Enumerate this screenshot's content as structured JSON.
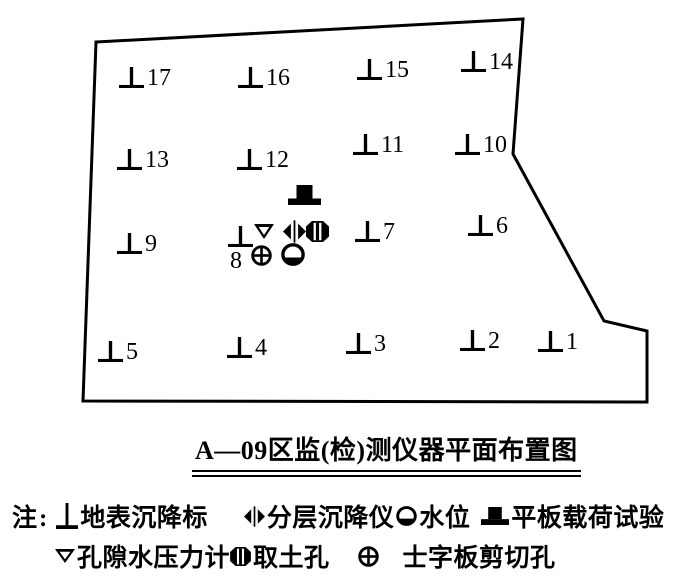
{
  "figure": {
    "background": "#ffffff",
    "ink": "#000000"
  },
  "plan": {
    "boundary_points": "96,42 523,19 513,154 604,321 647,331 647,402 83,401",
    "markers": [
      {
        "n": "17",
        "x": 119,
        "y": 64,
        "label_pos": "right"
      },
      {
        "n": "16",
        "x": 238,
        "y": 64,
        "label_pos": "right"
      },
      {
        "n": "15",
        "x": 357,
        "y": 56,
        "label_pos": "right"
      },
      {
        "n": "14",
        "x": 461,
        "y": 48,
        "label_pos": "right"
      },
      {
        "n": "13",
        "x": 117,
        "y": 146,
        "label_pos": "right"
      },
      {
        "n": "12",
        "x": 237,
        "y": 146,
        "label_pos": "right"
      },
      {
        "n": "11",
        "x": 353,
        "y": 131,
        "label_pos": "right"
      },
      {
        "n": "10",
        "x": 455,
        "y": 131,
        "label_pos": "right"
      },
      {
        "n": "9",
        "x": 117,
        "y": 230,
        "label_pos": "right"
      },
      {
        "n": "8",
        "x": 228,
        "y": 226,
        "label_pos": "below"
      },
      {
        "n": "7",
        "x": 355,
        "y": 218,
        "label_pos": "right"
      },
      {
        "n": "6",
        "x": 468,
        "y": 212,
        "label_pos": "right"
      },
      {
        "n": "5",
        "x": 98,
        "y": 338,
        "label_pos": "right"
      },
      {
        "n": "4",
        "x": 227,
        "y": 334,
        "label_pos": "right"
      },
      {
        "n": "3",
        "x": 346,
        "y": 330,
        "label_pos": "right"
      },
      {
        "n": "2",
        "x": 460,
        "y": 327,
        "label_pos": "right"
      },
      {
        "n": "1",
        "x": 538,
        "y": 328,
        "label_pos": "right"
      }
    ],
    "instruments": [
      {
        "type": "plate-load",
        "x": 288,
        "y": 185
      },
      {
        "type": "pore-pressure",
        "x": 254,
        "y": 224
      },
      {
        "type": "layered-settlement",
        "x": 283,
        "y": 220
      },
      {
        "type": "soil-sampling",
        "x": 306,
        "y": 221
      },
      {
        "type": "vane-shear",
        "x": 251,
        "y": 245
      },
      {
        "type": "water-level",
        "x": 281,
        "y": 243
      }
    ]
  },
  "caption": {
    "text": "A—09区监(检)测仪器平面布置图"
  },
  "legend": {
    "note_label": "注:",
    "rows": [
      [
        {
          "type": "settlement-marker",
          "label": "地表沉降标"
        },
        {
          "type": "layered-settlement",
          "label": "分层沉降仪"
        },
        {
          "type": "water-level",
          "label": "水位"
        },
        {
          "type": "plate-load",
          "label": "平板载荷试验"
        }
      ],
      [
        {
          "type": "pore-pressure",
          "label": "孔隙水压力计"
        },
        {
          "type": "soil-sampling",
          "label": "取土孔"
        },
        {
          "type": "vane-shear",
          "label": "士字板剪切孔"
        }
      ]
    ]
  }
}
